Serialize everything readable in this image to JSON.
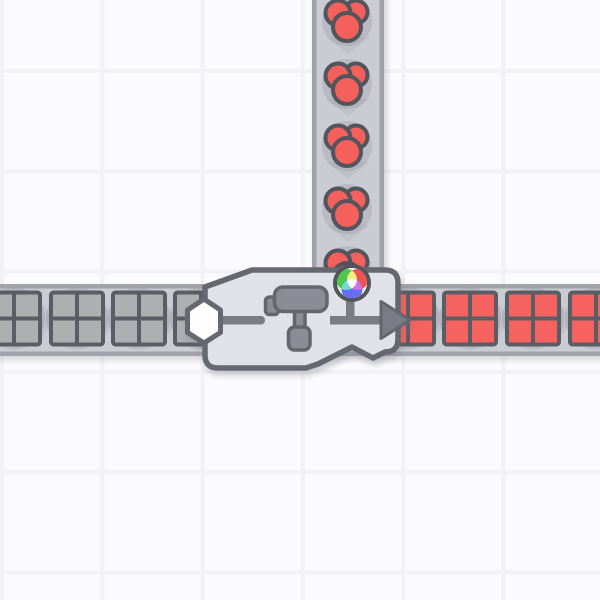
{
  "scene": {
    "app": "conveyor-factory-game",
    "description": "painter machine joining a vertical berry belt and a horizontal square-item belt",
    "grid": {
      "cell_size": 100.3,
      "line_width": 4,
      "offset_x": 0,
      "offset_y": 69
    },
    "colors": {
      "background": "#fbfbfd",
      "grid_line": "#f2f2f5",
      "belt_fill": "#cbccd3",
      "belt_edge": "#a1a2aa",
      "belt_chevron": "#c0c1c9",
      "item_halo": "rgba(145,147,160,0.30)",
      "outline_dark": "#5b5d64",
      "item_gray": "#aeafb3",
      "item_red": "#f5625f",
      "berry_red": "#f4605c",
      "berry_outline": "#53555d",
      "machine_fill": "#e1e2e9",
      "machine_border": "#666871",
      "icon_gray": "#8b8d96",
      "icon_outline": "#64666e",
      "pipe_gray": "#7a7c85",
      "port_white": "#fdfdfe",
      "wheel_green": "#4ec84a",
      "wheel_red": "#f15150",
      "wheel_blue": "#636ef0",
      "wheel_yellow": "#f3f07c",
      "wheel_cyan": "#74dad2",
      "wheel_magenta": "#cf70e6",
      "wheel_white": "#ffffff"
    },
    "vertical_belt": {
      "direction": "down",
      "x_center": 348,
      "width": 72,
      "edge_width": 4.5,
      "y_start": -6,
      "y_end": 300,
      "item_type": "red-berry-cluster",
      "item_centers_y": [
        21,
        84,
        146,
        209,
        271
      ],
      "chevron_centers_y": [
        0,
        45,
        107,
        170,
        233
      ]
    },
    "horizontal_belt": {
      "direction": "right",
      "y_center": 320,
      "height": 72,
      "edge_width": 4.5,
      "x_start": -6,
      "x_end": 606,
      "items_left": {
        "item_type": "square-2x2",
        "color_key": "item_gray",
        "centers_x": [
          14,
          77,
          139,
          201
        ]
      },
      "items_right": {
        "item_type": "square-2x2",
        "color_key": "item_red",
        "centers_x": [
          408,
          470,
          533,
          596
        ]
      },
      "chevron_centers_x": [
        46,
        108,
        170,
        439,
        502,
        564
      ]
    },
    "machine": {
      "name": "painter",
      "tool": "paint-roller",
      "input_port": "white-hexagon",
      "output_port": "gray-arrow-right",
      "indicator": "rgb-color-wheel",
      "bounds": {
        "left": 205,
        "top": 270,
        "right": 398,
        "bottom": 368
      },
      "hexagon_center": {
        "x": 204,
        "y": 321
      },
      "wheel_center": {
        "x": 352,
        "y": 283,
        "outer_r": 17,
        "lobe_r": 10.5
      },
      "pipe_y": 320,
      "arrow": {
        "back_x": 381,
        "tip_x": 410,
        "y_center": 320,
        "half_height": 18.5
      }
    }
  }
}
